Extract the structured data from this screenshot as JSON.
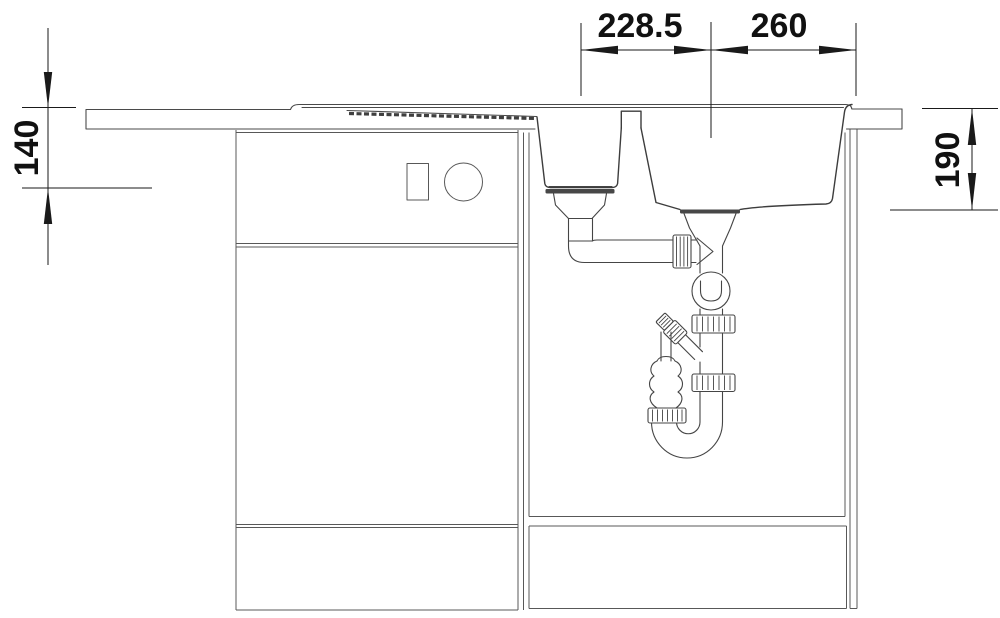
{
  "meta": {
    "type": "technical-installation-drawing",
    "subject": "kitchen sink with one-and-a-half bowls, cabinet and drain trap, sectional front view",
    "background": "#ffffff"
  },
  "colors": {
    "dimension_ink": "#1a1a1a",
    "outline_ink": "#4a4a4a",
    "bowl_ink": "#3d3d3d",
    "cabinet_ink": "#585858"
  },
  "dimensions": {
    "bowl_spacing": "228.5",
    "bowl_to_edge": "260",
    "small_bowl_depth": "140",
    "large_bowl_depth": "190"
  }
}
